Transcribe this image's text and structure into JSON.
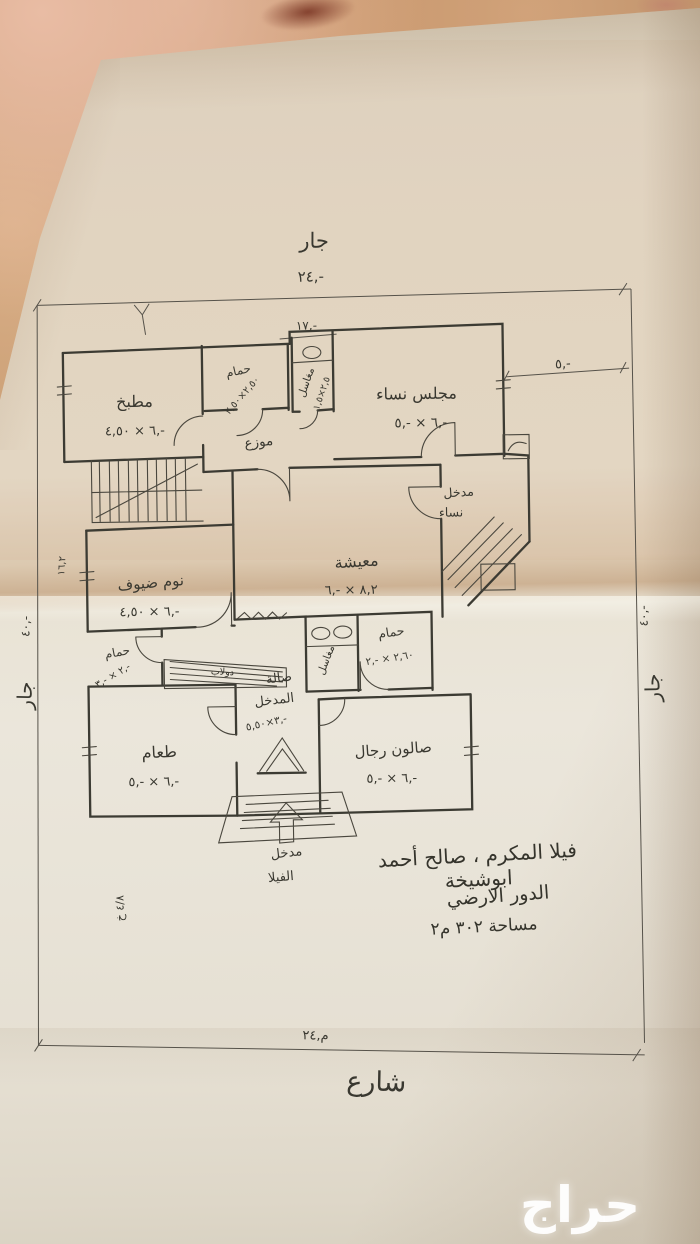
{
  "photo": {
    "watermark": "حراج"
  },
  "site": {
    "neighbor_top": "جار",
    "dim_top": "٢٤,-",
    "neighbor_left": "جار",
    "dim_left": "٤٠,-",
    "neighbor_right": "جار",
    "dim_right": "٤٠,-",
    "street": "شارع",
    "dim_street": "٢٤,م",
    "dim_inner_top": "١٧,-",
    "dim_setback_right": "٥,-",
    "edge_note_left": "١٦,٢",
    "edge_note_bottom_left": "خ ٤/٨"
  },
  "rooms": {
    "kitchen": {
      "name": "مطبخ",
      "dims": "٤,٥٠ × ٦,-"
    },
    "bath_top": {
      "name": "حمام",
      "dims": "٢,٥٠×٢,٥٠"
    },
    "wash_top": {
      "name": "مغاسل",
      "dims": "١,٥×٢,٥"
    },
    "majlis_women": {
      "name": "مجلس نساء",
      "dims": "٥,- × ٦,-"
    },
    "hallway": {
      "name": "موزع"
    },
    "entrance_women": {
      "name": "مدخل",
      "name2": "نساء"
    },
    "living": {
      "name": "معيشة",
      "dims": "٦,- × ٨,٢"
    },
    "guest_bedroom": {
      "name": "نوم ضيوف",
      "dims": "٤,٥٠ × ٦,-"
    },
    "bath_left": {
      "name": "حمام",
      "dims": "٣,- × ٢,-"
    },
    "closet": {
      "name": "دولاب"
    },
    "wash_mid": {
      "name": "مغاسل"
    },
    "bath_mid": {
      "name": "حمام",
      "dims": "٢,- × ٢,٦٠"
    },
    "entry_hall": {
      "name": "صالة",
      "name2": "المدخل",
      "dims": "٥,٥٠×٣,-"
    },
    "salon_men": {
      "name": "صالون رجال",
      "dims": "٥,- × ٦,-"
    },
    "dining": {
      "name": "طعام",
      "dims": "٥,- × ٦,-"
    },
    "villa_entrance": {
      "name": "مدخل",
      "name2": "الفيلا"
    }
  },
  "title_block": {
    "line1": "فيلا المكرم ، صالح أحمد ابوشيخة",
    "line2": "الدور الارضي",
    "line3": "مساحة ٣٠٢ م٢"
  }
}
